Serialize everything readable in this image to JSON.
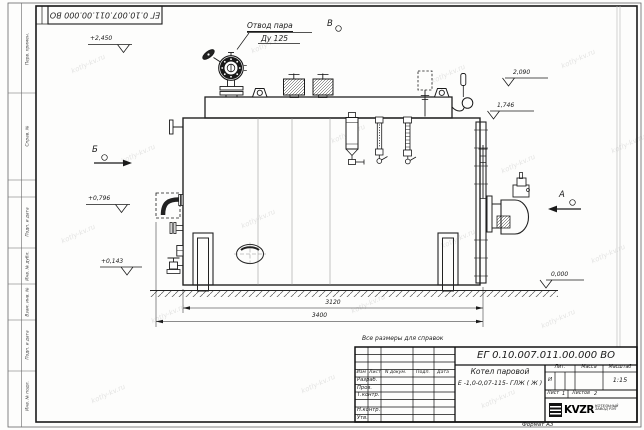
{
  "frame": {
    "top_stamp_number": "ЕГ 0.10.007.011.00.000  ВО",
    "format_note": "Формат А3",
    "strip_labels": {
      "perv_primen": "Перв. примен.",
      "sprav_no": "Справ. №",
      "podp_data_upper": "Подп. и дата",
      "inv_no_dubl": "Инв. № дубл.",
      "vzam_inv_no": "Взам. инв. №",
      "podp_data_lower": "Подп. и дата",
      "inv_no_podl": "Инв. № подл."
    }
  },
  "watermark": {
    "text": "kotly-kv.ru"
  },
  "drawing": {
    "callouts": {
      "steam_outlet": "Отвод пара",
      "steam_outlet_dn": "Ду 125"
    },
    "view_markers": {
      "a": "А",
      "b": "Б",
      "v": "В"
    },
    "elevations": {
      "top_left": "+2,450",
      "right_upper": "2,090",
      "right_lower": "1,746",
      "left_mid": "+0,796",
      "left_low": "+0,143",
      "ground": "0,000"
    },
    "dimensions": {
      "shell_length": "3120",
      "overall_length": "3400"
    },
    "note": "Все размеры для справок"
  },
  "title_block": {
    "doc_number": "ЕГ 0.10.007.011.00.000  ВО",
    "product_name": "Котел паровой",
    "product_code": "Е -1,0-0,07-115- ГЛЖ ( Ж )",
    "columns": {
      "izm": "Изм",
      "list": "Лист",
      "n_dokum": "N докум.",
      "podp": "Подп.",
      "data": "Дата"
    },
    "signature_rows": {
      "razrab": "Разраб.",
      "prov": "Пров.",
      "t_kontr": "Т.контр.",
      "n_kontr": "Н.контр.",
      "utv": "Утв."
    },
    "lit": {
      "label": "Лит.",
      "value": "И"
    },
    "massa": {
      "label": "Масса"
    },
    "masshtab": {
      "label": "Масштаб",
      "value": "1:15"
    },
    "list_info": {
      "label": "Лист",
      "value": "1",
      "total_label": "Листов",
      "total_value": "2"
    },
    "logo": {
      "brand": "KVZR",
      "line1": "КОТЕЛЬНЫЙ",
      "line2": "ЗАВОД РЭП"
    }
  }
}
